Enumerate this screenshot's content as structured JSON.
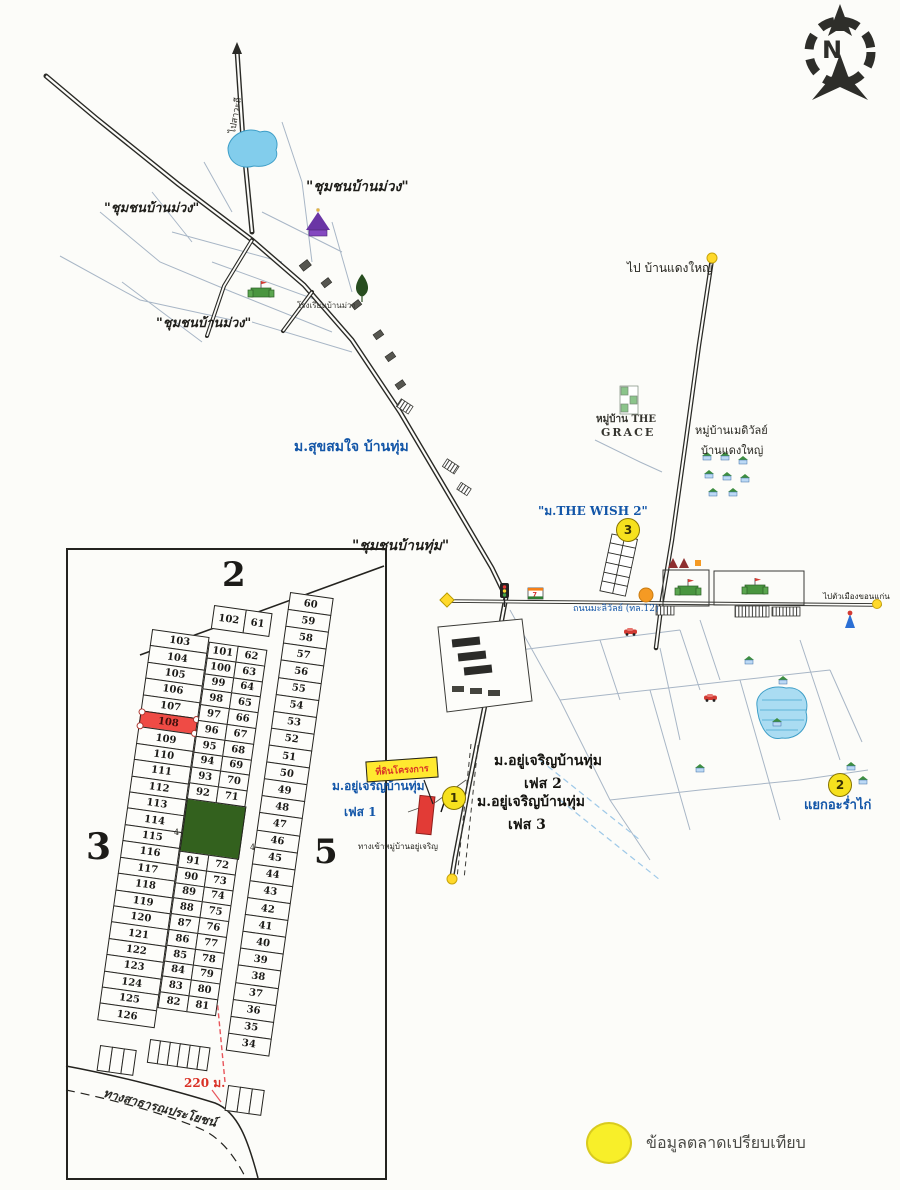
{
  "compass": {
    "label": "N"
  },
  "legend": {
    "label": "ข้อมูลตลาดเปรียบเทียบ",
    "marker_color": "#f8ef29"
  },
  "map": {
    "banner": {
      "text": "ที่ดินโครงการ",
      "bg": "#ffe92f",
      "text_color": "#d93025"
    },
    "markers": [
      {
        "n": "1",
        "x": 453,
        "y": 797
      },
      {
        "n": "2",
        "x": 839,
        "y": 784
      },
      {
        "n": "3",
        "x": 627,
        "y": 529
      }
    ],
    "labels": [
      {
        "text": "\"ชุมชนบ้านม่วง\"",
        "x": 306,
        "y": 176,
        "size": 14,
        "color": "#1f1e1a",
        "bold": true,
        "italic": true
      },
      {
        "text": "\"ชุมชนบ้านม่วง\"",
        "x": 104,
        "y": 197,
        "size": 13,
        "color": "#1f1e1a",
        "bold": true,
        "italic": true
      },
      {
        "text": "\"ชุมชนบ้านม่วง\"",
        "x": 156,
        "y": 312,
        "size": 13,
        "color": "#1f1e1a",
        "bold": true,
        "italic": true
      },
      {
        "text": "\"ชุมชนบ้านทุ่ม\"",
        "x": 352,
        "y": 535,
        "size": 14,
        "color": "#1f1e1a",
        "bold": true,
        "italic": true
      },
      {
        "text": "ม.สุขสมใจ บ้านทุ่ม",
        "x": 294,
        "y": 436,
        "size": 14,
        "color": "#1356a8",
        "bold": true
      },
      {
        "text": "\"ม.THE WISH 2\"",
        "x": 538,
        "y": 502,
        "size": 12,
        "color": "#1356a8",
        "bold": true
      },
      {
        "text": "ไป บ้านแดงใหญ่",
        "x": 627,
        "y": 259,
        "size": 12,
        "color": "#26251f"
      },
      {
        "text": "หมู่บ้าน THE",
        "x": 596,
        "y": 412,
        "size": 10,
        "color": "#35342e",
        "bold": true
      },
      {
        "text": "GRACE",
        "x": 601,
        "y": 426,
        "size": 11,
        "color": "#35342e",
        "bold": true,
        "spacing": 2
      },
      {
        "text": "หมู่บ้านเมดิวัลย์",
        "x": 695,
        "y": 421,
        "size": 11,
        "color": "#26251f"
      },
      {
        "text": "บ้านแดงใหญ่",
        "x": 701,
        "y": 441,
        "size": 11,
        "color": "#26251f"
      },
      {
        "text": "ม.อยู่เจริญบ้านทุ่ม",
        "x": 494,
        "y": 750,
        "size": 14,
        "color": "#14130f",
        "bold": true
      },
      {
        "text": "เฟส 2",
        "x": 524,
        "y": 773,
        "size": 14,
        "color": "#14130f",
        "bold": true
      },
      {
        "text": "ม.อยู่เจริญบ้านทุ่ม",
        "x": 477,
        "y": 791,
        "size": 14,
        "color": "#14130f",
        "bold": true
      },
      {
        "text": "เฟส 3",
        "x": 508,
        "y": 814,
        "size": 14,
        "color": "#14130f",
        "bold": true
      },
      {
        "text": "ม.อยู่เจริญบ้านทุ่ม",
        "x": 332,
        "y": 777,
        "size": 12,
        "color": "#1356a8",
        "bold": true
      },
      {
        "text": "เฟส 1",
        "x": 344,
        "y": 803,
        "size": 12,
        "color": "#1356a8",
        "bold": true
      },
      {
        "text": "ทางเข้าหมู่บ้านอยู่เจริญ",
        "x": 358,
        "y": 840,
        "size": 8,
        "color": "#26251f"
      },
      {
        "text": "แยกอะร่ำไก่",
        "x": 804,
        "y": 794,
        "size": 13,
        "color": "#1356a8",
        "bold": true
      },
      {
        "text": "ถนนมะลิวัลย์ (ทล.12)",
        "x": 573,
        "y": 601,
        "size": 9,
        "color": "#1356a8"
      },
      {
        "text": "ไปตัวเมืองขอนแก่น",
        "x": 823,
        "y": 590,
        "size": 8,
        "color": "#26251f"
      },
      {
        "text": "ไปสาวะถี",
        "x": 225,
        "y": 132,
        "size": 9,
        "color": "#26251f",
        "rotate": -80
      },
      {
        "text": "โรงเรียนบ้านม่วง",
        "x": 297,
        "y": 299,
        "size": 8,
        "color": "#3a3a34"
      },
      {
        "text": "4",
        "x": 174,
        "y": 828,
        "size": 8,
        "color": "#26251f"
      },
      {
        "text": "4",
        "x": 250,
        "y": 843,
        "size": 8,
        "color": "#26251f"
      }
    ],
    "icons": [
      "north-compass",
      "pond",
      "temple",
      "tree",
      "school-castle",
      "traffic-light",
      "seven-eleven-sign",
      "house",
      "red-car",
      "factory-compound",
      "field-strip",
      "yellow-dot",
      "yellow-diamond",
      "orange-circle",
      "shrine"
    ]
  },
  "inset": {
    "zones": [
      "2",
      "3",
      "5"
    ],
    "measure": "220 ม.",
    "road_label": "ทางสาธารณประโยชน์",
    "highlight_plot": "108",
    "plots": {
      "col_a": [
        "103",
        "104",
        "105",
        "106",
        "107",
        "108",
        "109",
        "110",
        "111",
        "112",
        "113",
        "114",
        "115",
        "116",
        "117",
        "118",
        "119",
        "120",
        "121",
        "122",
        "123",
        "124",
        "125",
        "126"
      ],
      "top_pair": [
        "102",
        "61"
      ],
      "col_b_upper": [
        "101",
        "100",
        "99",
        "98",
        "97",
        "96",
        "95",
        "94",
        "93",
        "92"
      ],
      "col_c_upper": [
        "62",
        "63",
        "64",
        "65",
        "66",
        "67",
        "68",
        "69",
        "70",
        "71"
      ],
      "col_b_lower": [
        "91",
        "90",
        "89",
        "88",
        "87",
        "86",
        "85",
        "84",
        "83",
        "82"
      ],
      "col_c_lower": [
        "72",
        "73",
        "74",
        "75",
        "76",
        "77",
        "78",
        "79",
        "80",
        "81"
      ],
      "col_d": [
        "60",
        "59",
        "58",
        "57",
        "56",
        "55",
        "54",
        "53",
        "52",
        "51",
        "50",
        "49",
        "48",
        "47",
        "46",
        "45",
        "44",
        "43",
        "42",
        "41",
        "40",
        "39",
        "38",
        "37",
        "36",
        "35",
        "34"
      ]
    },
    "strips": {
      "under_a": 3,
      "under_bc": 6,
      "under_d": 3
    }
  }
}
